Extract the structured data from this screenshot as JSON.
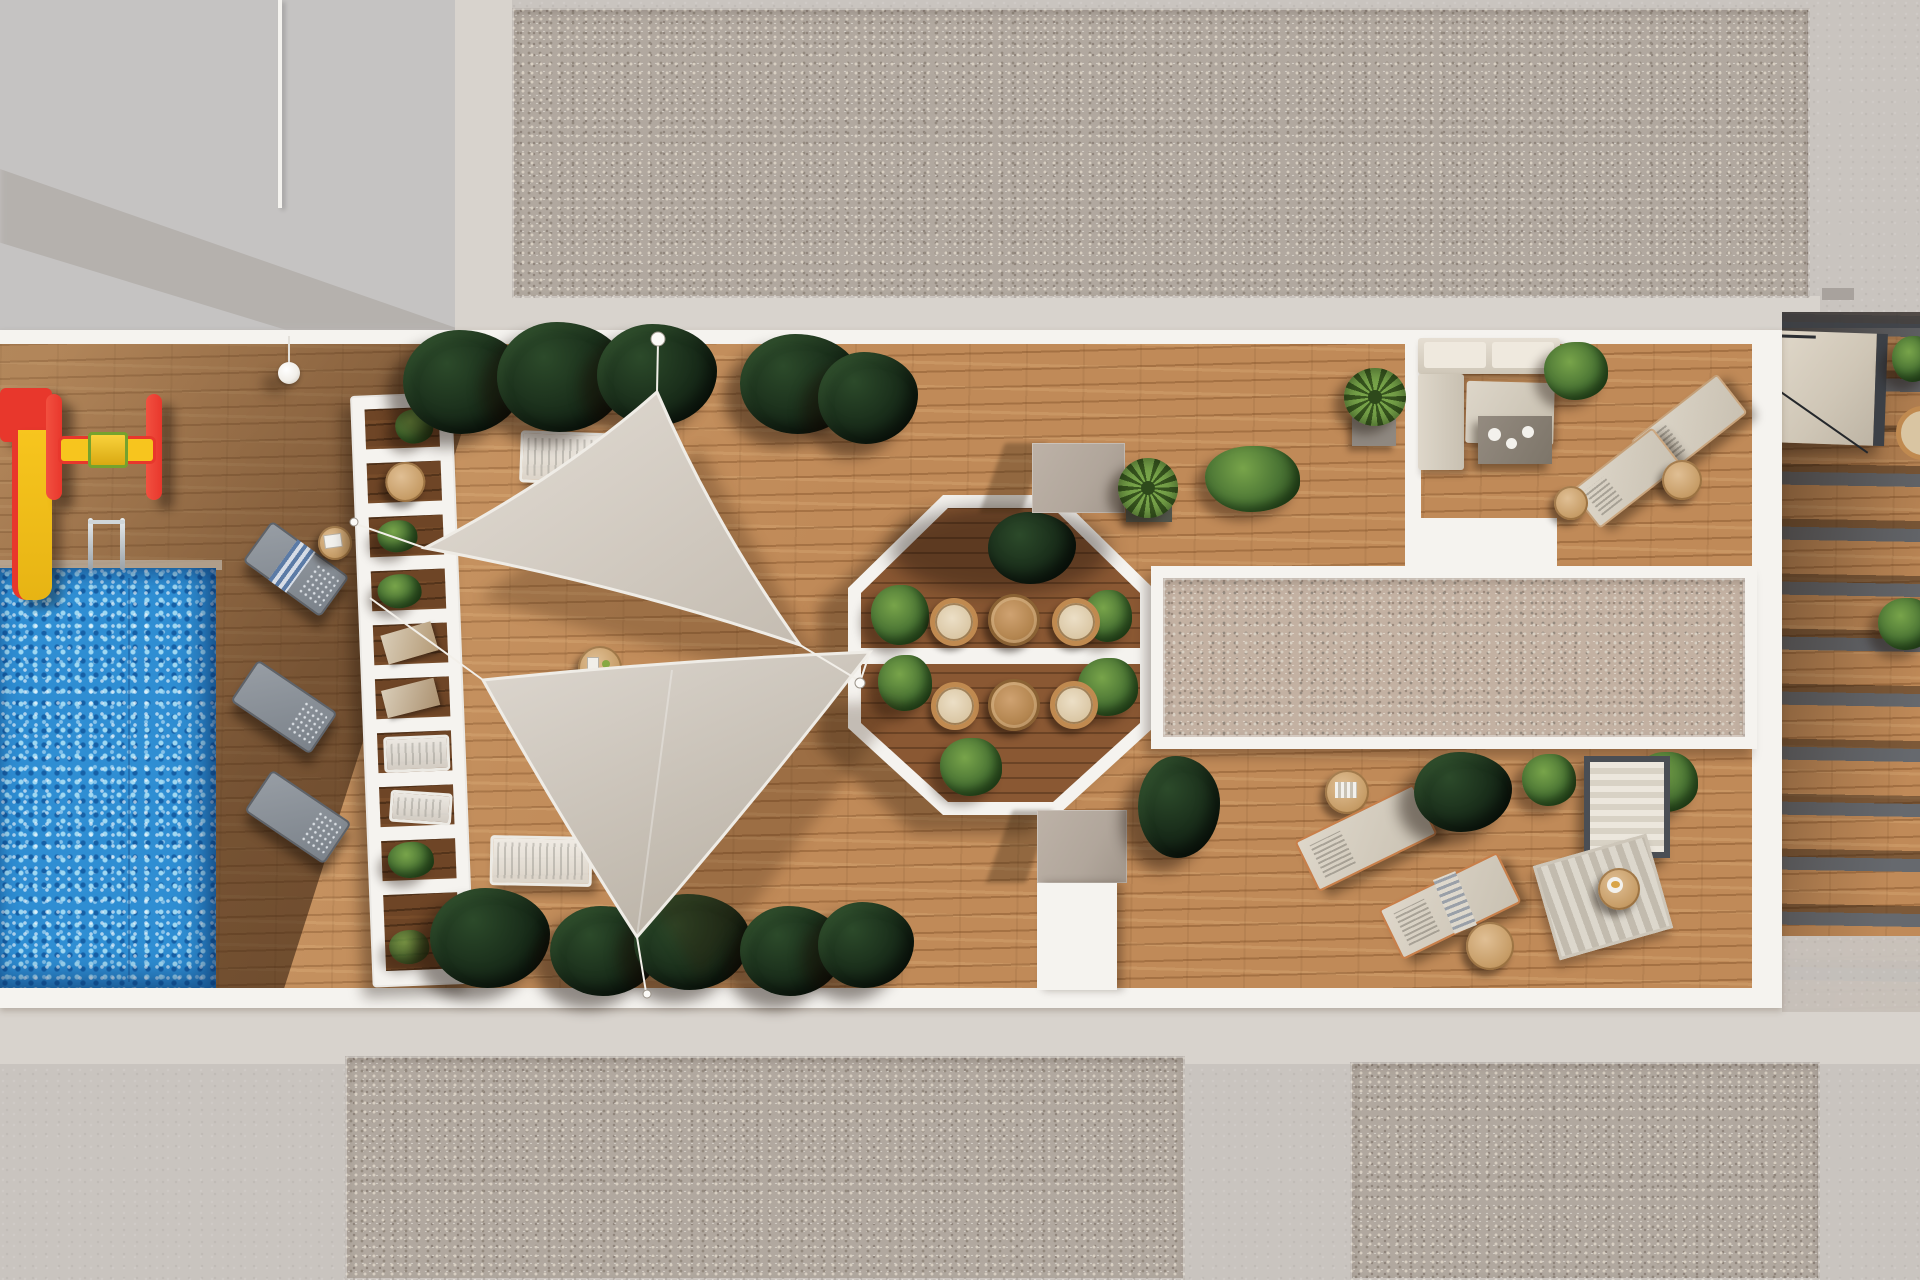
{
  "scene": {
    "title": "Aerial 3D render of a residential rooftop terrace",
    "width_px": 1920,
    "height_px": 1280,
    "view": "top-down architectural visualization, afternoon sun casting shadows to the lower-left"
  },
  "areas": {
    "roof_top_gravel": "Upper gravel roof field",
    "roof_bottom_left_gravel": "Lower-left gravel roof field",
    "roof_bottom_right_gravel": "Lower-right gravel roof field",
    "concrete_surround": "Concrete roof surround",
    "main_deck": "Main timber terrace deck",
    "pool": "Swimming pool with sparkling water",
    "playground": "Children's play corner with slide and spinner",
    "pergola_shelf": "White slatted shelf structure with planters and trays",
    "shade_sails": "Two triangular shade sails over lounger area",
    "octagon_atrium": "Octagonal dining atrium with bistro sets",
    "skylight_strip": "Long gravel skylight strip",
    "lounge_room": "Top-right lounge with sectional sofa and loungers",
    "sunbathing_area": "Lower-right sunbathing area with loungers and daybed",
    "stairs": "Right-hand stair and skylight zone with slatted pergola"
  },
  "inventory": {
    "shade_sails": 2,
    "sail_poles": 4,
    "gray_poolside_loungers": 3,
    "white_mesh_loungers": 2,
    "beige_loungers_lounge_room": 2,
    "beige_loungers_sunbathing": 2,
    "bistro_chairs_in_octagon": 4,
    "bistro_tables_in_octagon": 2,
    "sectional_sofa": 1,
    "coffee_table": 1,
    "daybed": 1,
    "rug": 1,
    "side_tables": 7,
    "dark_tropical_plant_clusters": 12,
    "green_shrubs": 10,
    "yucca_plants": 3,
    "planter_boxes_on_octagon_axis": 2,
    "pool_ladder": 1,
    "hanging_lamp": 1,
    "pergola_openings": 10
  },
  "palette": {
    "concrete_mid": "#c9c4bf",
    "concrete_cool": "#c5c3c2",
    "concrete_light": "#d8d3cd",
    "concrete_shadow": "#a8a29d",
    "gravel_base": "#b1a89f",
    "gravel_pink": "#c3b1a2",
    "gravel_dot_light": "#d8cfc2",
    "gravel_dot_dark": "#93897e",
    "white_struct": "#f5f3ef",
    "wood_light": "#c08a58",
    "wood_dark": "#6e4526",
    "wood_floor_octagon": "#8a5833",
    "pool_base": "#2f8ed3",
    "pool_sparkle": "#9fd8f2",
    "pool_deep": "#1660a6",
    "sail_light": "#ddd7cf",
    "sail_dark": "#c4bcb1",
    "plant_dark": "#182b19",
    "plant_green": "#4a7434",
    "plant_bright": "#78a44a",
    "taupe_box": "#b1a69b",
    "slat_gray": "#66696e",
    "frame_dark": "#3c4046",
    "rattan": "#c08a50",
    "copper": "#c87f4a",
    "play_red": "#e8372c",
    "play_yellow": "#f7c51e",
    "lamp_white": "#f2efe9"
  }
}
